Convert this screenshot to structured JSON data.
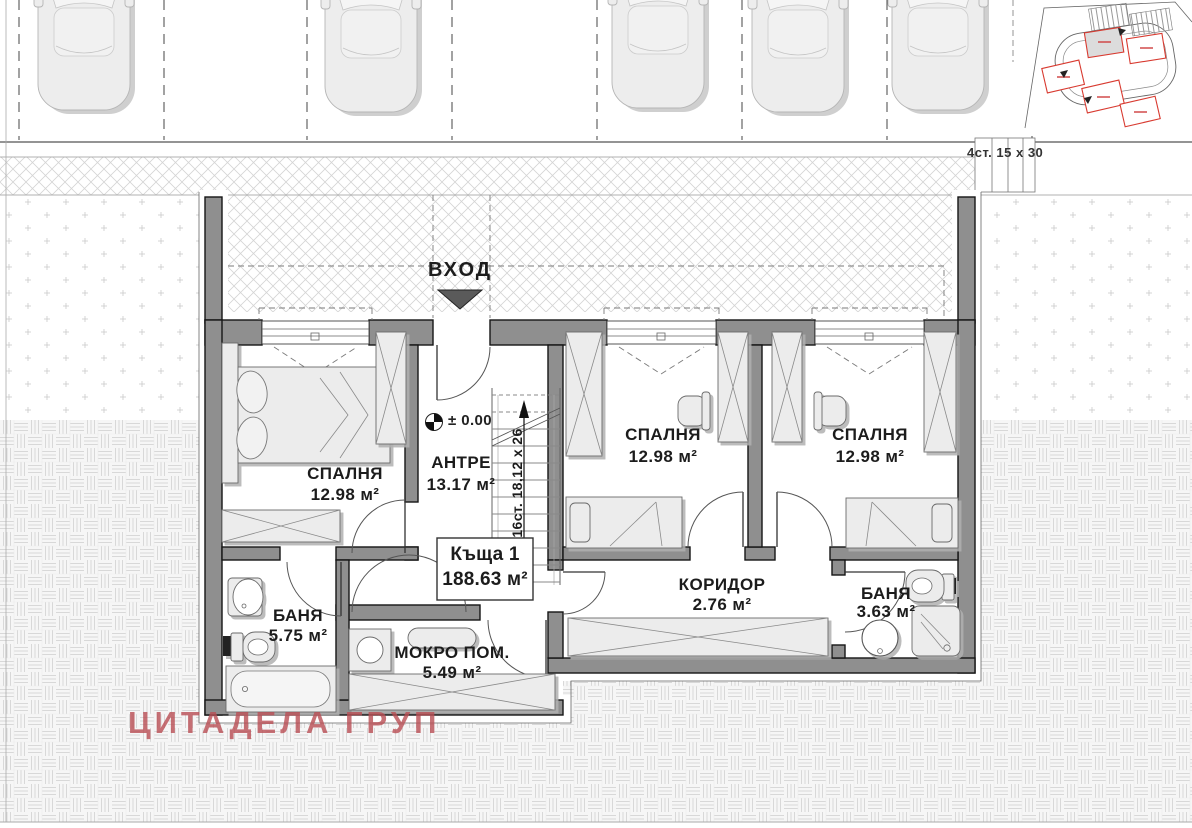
{
  "watermark": {
    "text": "ЦИТАДЕЛА ГРУП"
  },
  "entrance": {
    "label": "ВХОД"
  },
  "house": {
    "name": "Къща 1",
    "area": "188.63 м²"
  },
  "rooms": {
    "bedroom_left": {
      "name": "СПАЛНЯ",
      "area": "12.98 м²"
    },
    "hall": {
      "name": "АНТРЕ",
      "area": "13.17 м²"
    },
    "bedroom_middle": {
      "name": "СПАЛНЯ",
      "area": "12.98 м²"
    },
    "bedroom_right": {
      "name": "СПАЛНЯ",
      "area": "12.98 м²"
    },
    "bathroom_left": {
      "name": "БАНЯ",
      "area": "5.75 м²"
    },
    "wet_room": {
      "name": "МОКРО ПОМ.",
      "area": "5.49 м²"
    },
    "corridor": {
      "name": "КОРИДОР",
      "area": "2.76 м²"
    },
    "bathroom_right": {
      "name": "БАНЯ",
      "area": "3.63 м²"
    }
  },
  "annotations": {
    "level_mark": "± 0.00",
    "stair_note": "16ст. 18,12 x 26",
    "outdoor_steps_note": "4ст. 15 x 30"
  },
  "colors": {
    "wall": "#8f8f8f",
    "watermark": "#b94e54",
    "site_outline_red": "#d83a30"
  }
}
